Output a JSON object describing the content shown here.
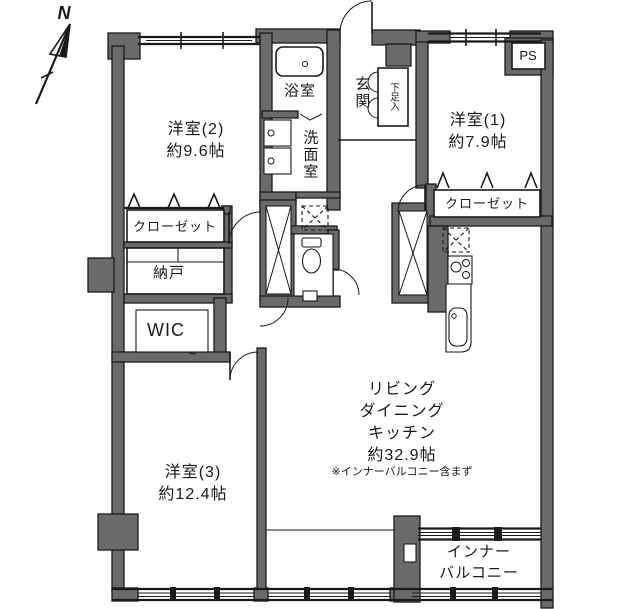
{
  "plan": {
    "compass_label": "N",
    "rooms": {
      "west2": {
        "name": "洋室(2)",
        "size": "約9.6帖"
      },
      "west1": {
        "name": "洋室(1)",
        "size": "約7.9帖"
      },
      "west3": {
        "name": "洋室(3)",
        "size": "約12.4帖"
      },
      "bath": {
        "name": "浴室"
      },
      "washroom": {
        "name": "洗面室"
      },
      "entrance": {
        "name": "玄関"
      },
      "shoe_cabinet": {
        "name": "下足入"
      },
      "pipe_space": {
        "name": "PS"
      },
      "closet_west2": {
        "name": "クローゼット"
      },
      "closet_west1": {
        "name": "クローゼット"
      },
      "storage": {
        "name": "納戸"
      },
      "wic": {
        "name": "WIC"
      },
      "ldk": {
        "line1": "リビング",
        "line2": "ダイニング",
        "line3": "キッチン",
        "size": "約32.9帖",
        "note": "※インナーバルコニー含まず"
      },
      "inner_balcony": {
        "line1": "インナー",
        "line2": "バルコニー"
      }
    },
    "colors": {
      "wall": "#6a6a6a",
      "line": "#1a1a1a",
      "bg": "#ffffff"
    }
  }
}
